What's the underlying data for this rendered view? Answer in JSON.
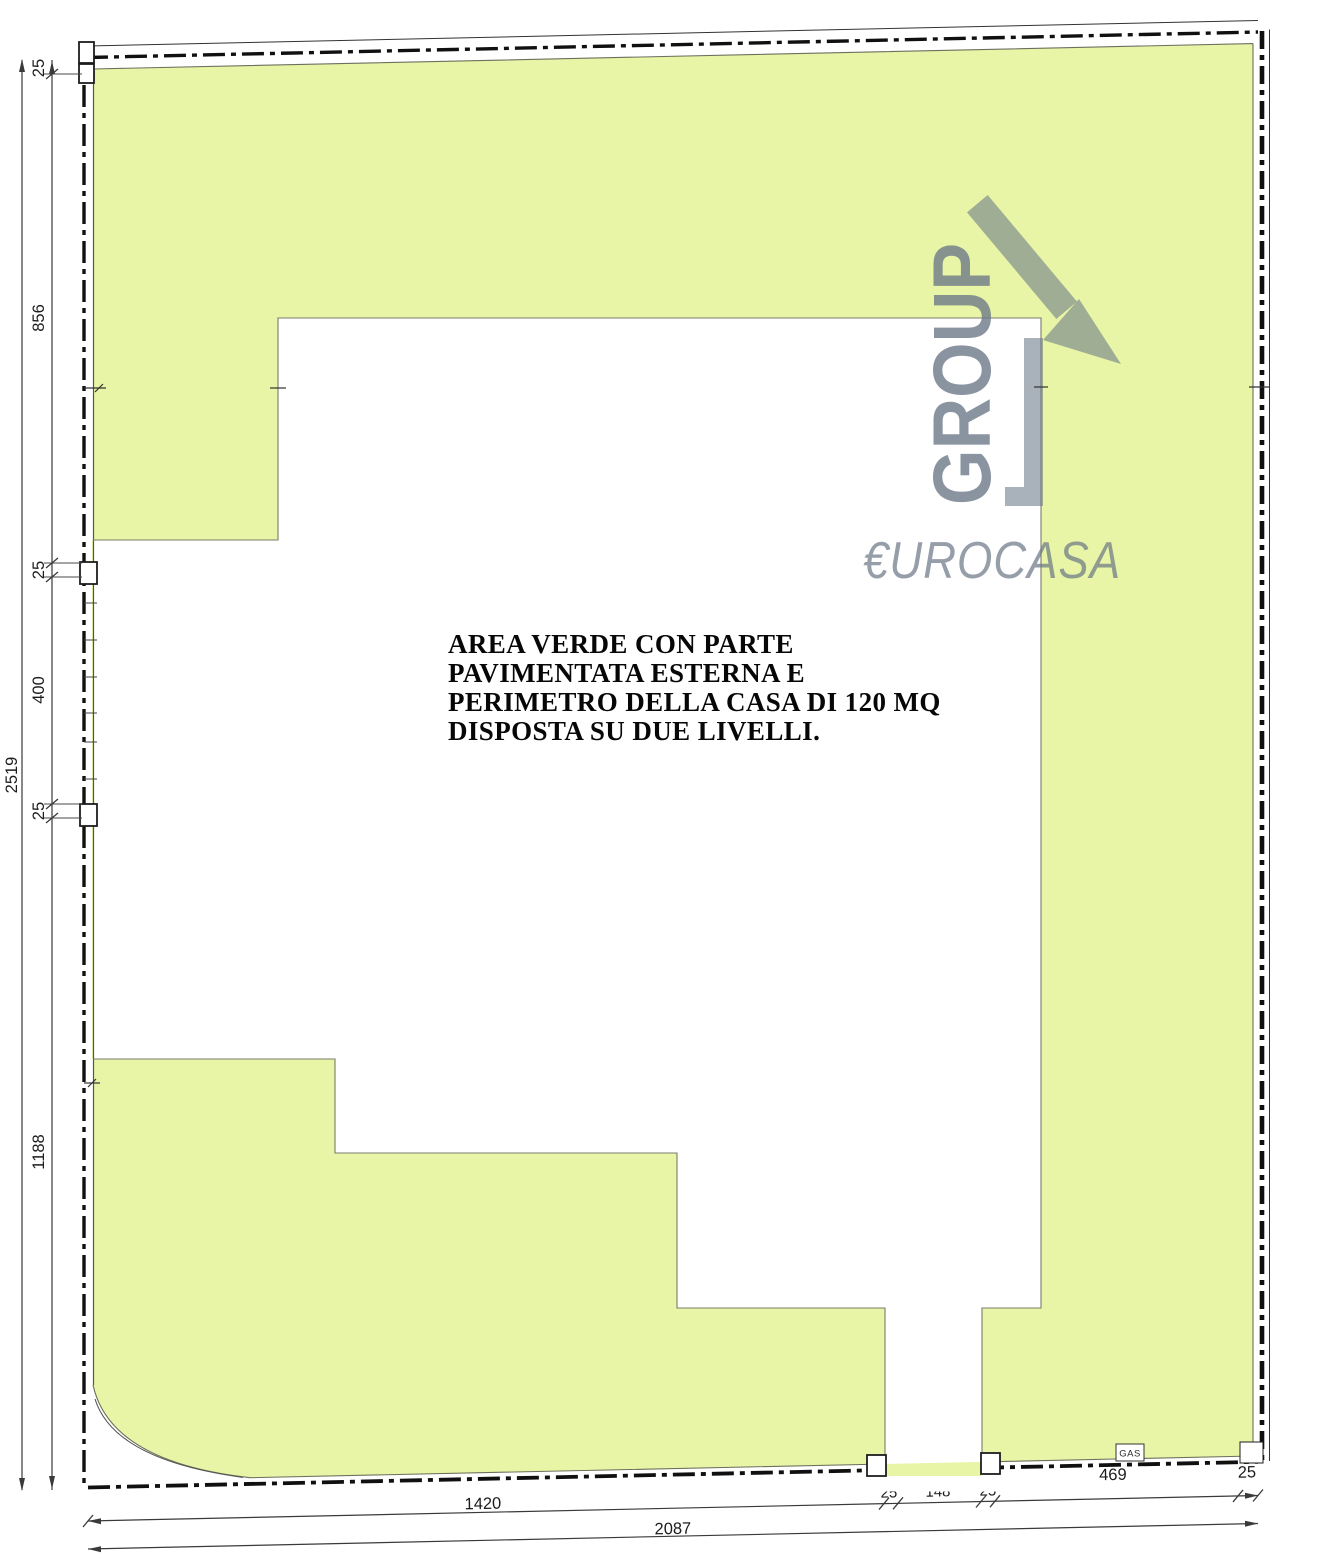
{
  "annotation": {
    "lines": [
      "AREA VERDE CON PARTE",
      "PAVIMENTATA ESTERNA E",
      "PERIMETRO DELLA CASA DI 120 MQ",
      "DISPOSTA SU DUE LIVELLI."
    ]
  },
  "logo": {
    "group": "GROUP",
    "name": "€UROCASA"
  },
  "dimensions": {
    "left_total": "2519",
    "left": [
      "25",
      "856",
      "25",
      "400",
      "25",
      "1188"
    ],
    "bottom": [
      "1420",
      "25",
      "148",
      "25",
      "469",
      "25"
    ],
    "bottom_total": "2087"
  },
  "labels": {
    "gas": "GAS"
  },
  "colors": {
    "green": "#E8F5A6",
    "logo_gray": "#6D7988",
    "line": "#1A1A1A"
  }
}
